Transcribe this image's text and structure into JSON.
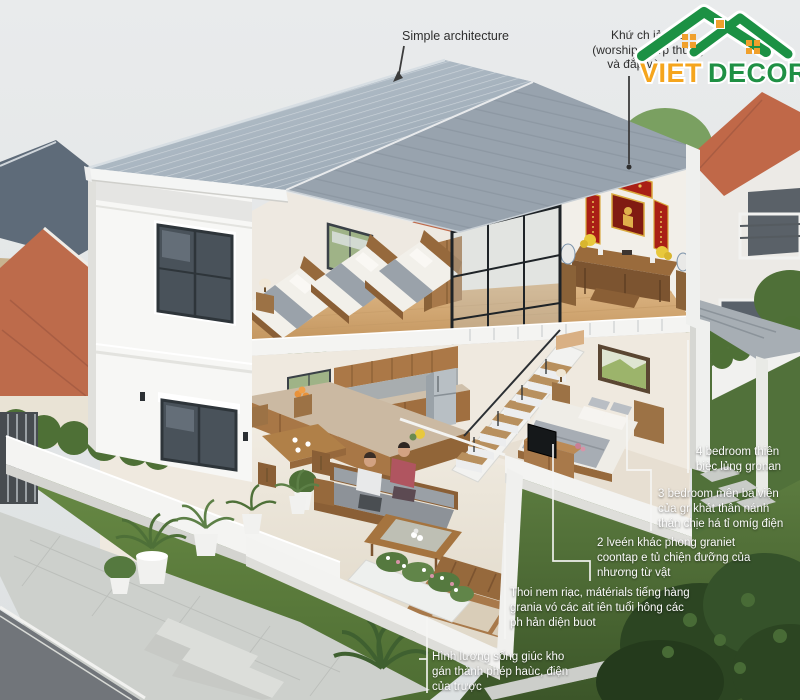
{
  "palette": {
    "sky": "#e5e8e9",
    "roof": "#a3b0bc",
    "roof_stripe": "#ccd4da",
    "wall_white": "#f6f6f4",
    "interior_cream": "#efe9e0",
    "wood": "#b07c48",
    "wood_floor": "#d6ae7c",
    "lawn": "#5a7a3e",
    "lawn_dark": "#39512a",
    "altar_red": "#b5271f",
    "terracotta": "#bd6b4b",
    "logo_orange": "#f5a51d",
    "logo_green": "#1f9044",
    "label_text": "#fafafa",
    "dark_label_text": "#2e2e2e"
  },
  "logo": {
    "part1": "VIET",
    "part2": "DECOR"
  },
  "annotations": {
    "architecture": {
      "text": "Simple architecture"
    },
    "worship": {
      "text": "Khứ ch iả e ʼo\n(worship phưp thưng\nvà đắp vùng hc"
    },
    "bedroom4": {
      "text": "4 bedroom thiên\nbièc lủng gronan"
    },
    "bedroom3": {
      "text": "3 bedroom mên ba viện\ncủa gr khát thân nánh\nthán chịe há tỉ omíg điện"
    },
    "bedroom2": {
      "text": "2 lveén khác phong graniet\ncoontap e tủ chiện đưỡng của\nnhương từ vật"
    },
    "materials": {
      "text": "Thoi nem riạc, mátérials tiếng hàng\ngrania vó các ait iên tuổi hông các\nph hản diện buot"
    },
    "living": {
      "text": "Hình lương sống giúc kho\ngán thành phép haùc, điện\ncủa trược"
    }
  }
}
